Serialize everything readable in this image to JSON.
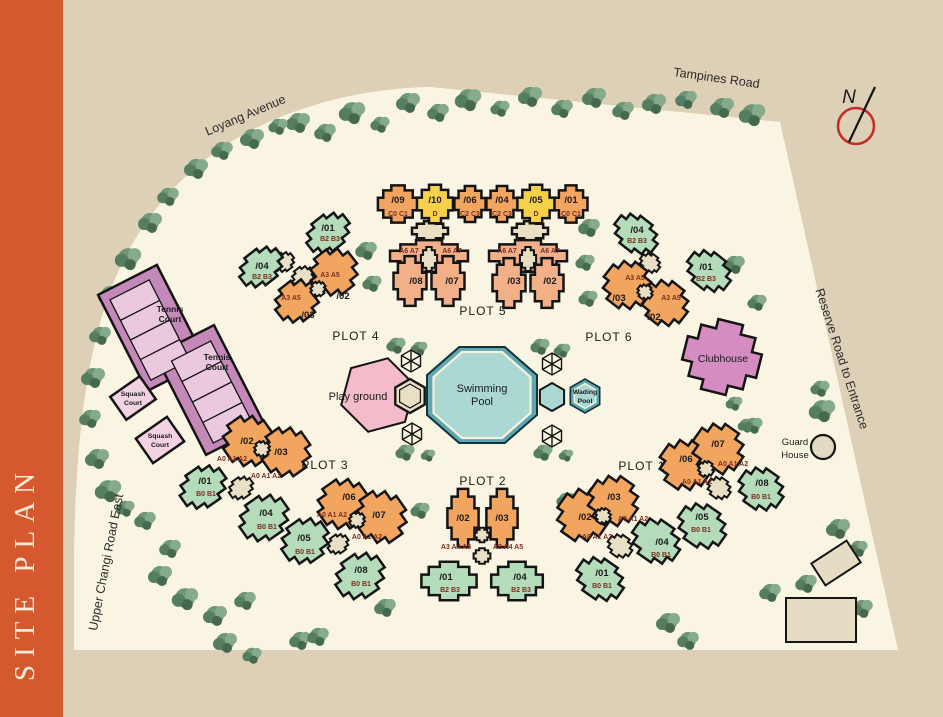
{
  "title": "SITE PLAN",
  "compass": {
    "label": "N"
  },
  "roads": {
    "loyang": "Loyang Avenue",
    "tampines": "Tampines Road",
    "reserve": "Reserve Road to Entrance",
    "upper_changi": "Upper Changi Road East"
  },
  "facilities": {
    "tennis1": [
      "Tennis",
      "Court"
    ],
    "tennis2": [
      "Tennis",
      "Court"
    ],
    "squash1": [
      "Squash",
      "Court"
    ],
    "squash2": [
      "Squash",
      "Court"
    ],
    "playground": "Play ground",
    "swimming": [
      "Swimming",
      "Pool"
    ],
    "wading": [
      "Wading",
      "Pool"
    ],
    "clubhouse": "Clubhouse",
    "guard": [
      "Guard",
      "House"
    ]
  },
  "plots": {
    "plot5": {
      "label": "PLOT 5",
      "top_row": [
        {
          "unit": "/09",
          "type": "C0 C1"
        },
        {
          "unit": "/10",
          "type": "D"
        },
        {
          "unit": "/06",
          "type": "C2 C3"
        },
        {
          "unit": "/04",
          "type": "C2 C3"
        },
        {
          "unit": "/05",
          "type": "D"
        },
        {
          "unit": "/01",
          "type": "C0 C1"
        }
      ],
      "cluster_types": [
        "A6 A7",
        "A6 A7",
        "A6 A7",
        "A6 A7"
      ],
      "cluster_units": [
        "/08",
        "/07",
        "/03",
        "/02"
      ]
    },
    "plot4": {
      "label": "PLOT 4",
      "green": [
        {
          "unit": "/01",
          "type": "B2 B3"
        },
        {
          "unit": "/04",
          "type": "B2 B3"
        }
      ],
      "orange_types": [
        "A3 A5",
        "A3 A5"
      ],
      "orange_units": [
        "/02",
        "/03"
      ]
    },
    "plot6": {
      "label": "PLOT 6",
      "green": [
        {
          "unit": "/04",
          "type": "B2 B3"
        },
        {
          "unit": "/01",
          "type": "B2 B3"
        }
      ],
      "orange_types": [
        "A3 A5",
        "A3 A5"
      ],
      "orange_units": [
        "/03",
        "/02"
      ]
    },
    "plot3": {
      "label": "PLOT 3",
      "orange": [
        {
          "unit": "/02",
          "type": "A0 A1 A2"
        },
        {
          "unit": "/03",
          "type": "A0 A1 A2"
        },
        {
          "unit": "/06",
          "type": "A0 A1 A2"
        },
        {
          "unit": "/07",
          "type": "A0 A1 A2"
        }
      ],
      "green": [
        {
          "unit": "/01",
          "type": "B0 B1"
        },
        {
          "unit": "/04",
          "type": "B0 B1"
        },
        {
          "unit": "/05",
          "type": "B0 B1"
        },
        {
          "unit": "/08",
          "type": "B0 B1"
        }
      ]
    },
    "plot2": {
      "label": "PLOT 2",
      "orange": [
        {
          "unit": "/02",
          "type": "A3 A4 A5"
        },
        {
          "unit": "/03",
          "type": "A3 A4 A5"
        }
      ],
      "green": [
        {
          "unit": "/01",
          "type": "B2 B3"
        },
        {
          "unit": "/04",
          "type": "B2 B3"
        }
      ]
    },
    "plot1": {
      "label": "PLOT 1",
      "orange": [
        {
          "unit": "/02",
          "type": "A0 A1 A2"
        },
        {
          "unit": "/03",
          "type": "A0 A1 A2"
        },
        {
          "unit": "/06",
          "type": "A0 A1 A2"
        },
        {
          "unit": "/07",
          "type": "A0 A1 A2"
        }
      ],
      "green": [
        {
          "unit": "/01",
          "type": "B0 B1"
        },
        {
          "unit": "/04",
          "type": "B0 B1"
        },
        {
          "unit": "/05",
          "type": "B0 B1"
        },
        {
          "unit": "/08",
          "type": "B0 B1"
        }
      ]
    }
  },
  "colors": {
    "accent_bar": "#d6582f",
    "site": "#faf5e2",
    "background": "#ddd0b6",
    "building_orange": "#f2a55f",
    "building_yellow": "#f7d14a",
    "building_salmon": "#f2b088",
    "building_green": "#b4dcba",
    "connector_beige": "#e8dfc4",
    "tennis_outer": "#c589b9",
    "tennis_inner": "#eac9df",
    "squash": "#f3d2e2",
    "clubhouse": "#d58cc0",
    "playground": "#f4bccb",
    "pool_rim": "#5fa7b0",
    "pool_water": "#abd8d2",
    "tree_green": "#6e9776",
    "north_ring_red": "#c03028",
    "type_label_maroon": "#7c2d21"
  }
}
